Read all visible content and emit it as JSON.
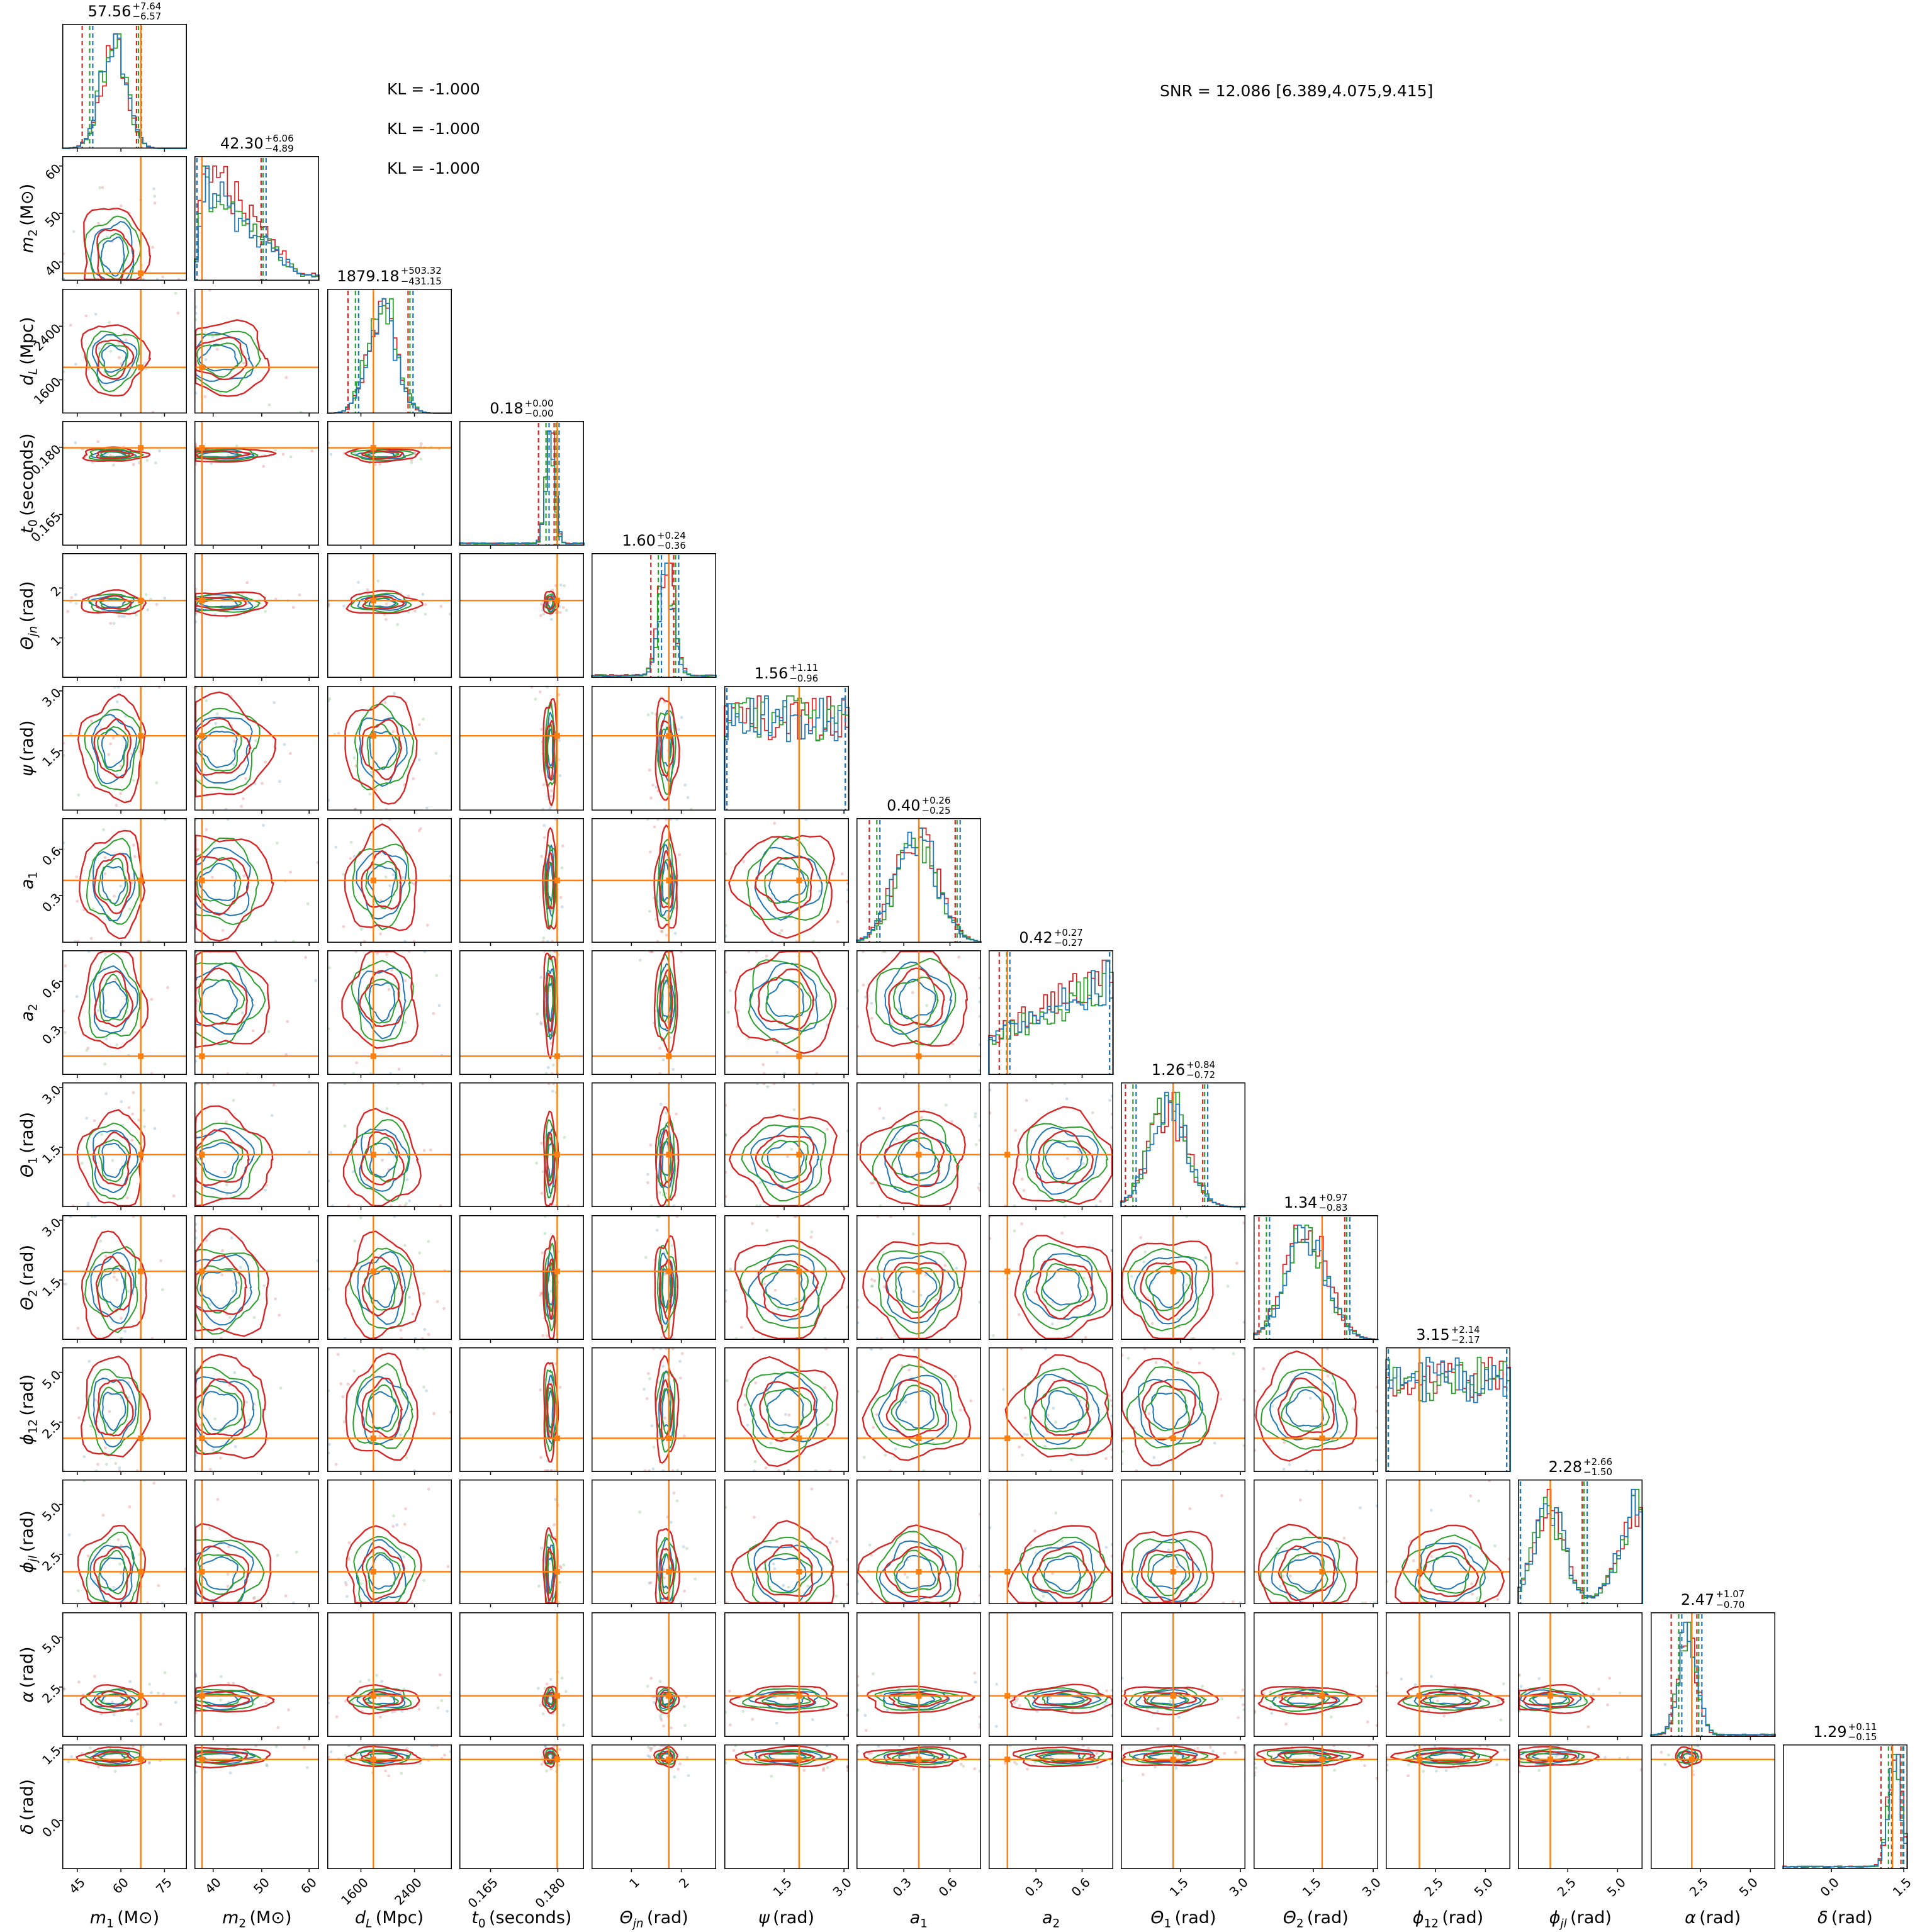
{
  "figure": {
    "annotations": {
      "kl_lines": [
        {
          "text": "KL = -1.000"
        },
        {
          "text": "KL = -1.000"
        },
        {
          "text": "KL = -1.000"
        }
      ],
      "snr": {
        "text": "SNR = 12.086 [6.389,4.075,9.415]"
      }
    }
  },
  "chart_data": {
    "type": "scatter",
    "subtype": "corner-plot-posterior",
    "n_parameters": 14,
    "series": [
      {
        "name": "posterior-run-1",
        "color": "#d62728"
      },
      {
        "name": "posterior-run-2",
        "color": "#2ca02c"
      },
      {
        "name": "posterior-run-3",
        "color": "#1f77b4"
      }
    ],
    "truth_color": "#ff7f0e",
    "annotations": [
      "KL = -1.000",
      "KL = -1.000",
      "KL = -1.000",
      "SNR = 12.086 [6.389,4.075,9.415]"
    ],
    "parameters": [
      {
        "name": "m1",
        "var": "m",
        "sub": "1",
        "unit": "(M⊙)",
        "median": "57.56",
        "plus": "+7.64",
        "minus": "−6.57",
        "ticks": [
          "45",
          "60",
          "75"
        ],
        "tick_fracs": [
          0.12,
          0.47,
          0.82
        ],
        "truth": 67.0,
        "truth_frac": 0.63,
        "shape": "bell",
        "peak": 0.41,
        "width": 0.17
      },
      {
        "name": "m2",
        "var": "m",
        "sub": "2",
        "unit": "(M⊙)",
        "median": "42.30",
        "plus": "+6.06",
        "minus": "−4.89",
        "ticks": [
          "40",
          "50",
          "60"
        ],
        "tick_fracs": [
          0.15,
          0.54,
          0.92
        ],
        "truth": 37.5,
        "truth_frac": 0.06,
        "shape": "fall",
        "peak": 0.2,
        "width": 0.3
      },
      {
        "name": "dL",
        "var": "d",
        "sub": "L",
        "unit": "(Mpc)",
        "median": "1879.18",
        "plus": "+503.32",
        "minus": "−431.15",
        "ticks": [
          "1600",
          "2400"
        ],
        "tick_fracs": [
          0.27,
          0.7
        ],
        "truth": 1790,
        "truth_frac": 0.37,
        "shape": "bell",
        "peak": 0.44,
        "width": 0.19
      },
      {
        "name": "t0",
        "var": "t",
        "sub": "0",
        "unit": "(seconds)",
        "median": "0.18",
        "plus": "+0.00",
        "minus": "−0.00",
        "ticks": [
          "0.165",
          "0.180"
        ],
        "tick_fracs": [
          0.25,
          0.79
        ],
        "truth": 0.18,
        "truth_frac": 0.785,
        "shape": "spike",
        "peak": 0.73,
        "width": 0.035
      },
      {
        "name": "theta_jn",
        "var": "Θ",
        "sub": "jn",
        "unit": "(rad)",
        "median": "1.60",
        "plus": "+0.24",
        "minus": "−0.36",
        "ticks": [
          "1",
          "2"
        ],
        "tick_fracs": [
          0.32,
          0.72
        ],
        "truth": 1.75,
        "truth_frac": 0.62,
        "shape": "spike",
        "peak": 0.6,
        "width": 0.06
      },
      {
        "name": "psi",
        "var": "ψ",
        "sub": "",
        "unit": "(rad)",
        "median": "1.56",
        "plus": "+1.11",
        "minus": "−0.96",
        "ticks": [
          "1.5",
          "3.0"
        ],
        "tick_fracs": [
          0.48,
          0.96
        ],
        "truth": 1.9,
        "truth_frac": 0.6,
        "shape": "flat",
        "peak": 0.5,
        "width": 0.45
      },
      {
        "name": "a1",
        "var": "a",
        "sub": "1",
        "unit": "",
        "median": "0.40",
        "plus": "+0.26",
        "minus": "−0.25",
        "ticks": [
          "0.3",
          "0.6"
        ],
        "tick_fracs": [
          0.38,
          0.75
        ],
        "truth": 0.4,
        "truth_frac": 0.5,
        "shape": "bell",
        "peak": 0.48,
        "width": 0.28
      },
      {
        "name": "a2",
        "var": "a",
        "sub": "2",
        "unit": "",
        "median": "0.42",
        "plus": "+0.27",
        "minus": "−0.27",
        "ticks": [
          "0.3",
          "0.6"
        ],
        "tick_fracs": [
          0.38,
          0.75
        ],
        "truth": 0.12,
        "truth_frac": 0.15,
        "shape": "rise",
        "peak": 0.6,
        "width": 0.4
      },
      {
        "name": "theta_1",
        "var": "Θ",
        "sub": "1",
        "unit": "(rad)",
        "median": "1.26",
        "plus": "+0.84",
        "minus": "−0.72",
        "ticks": [
          "1.5",
          "3.0"
        ],
        "tick_fracs": [
          0.48,
          0.96
        ],
        "truth": 1.3,
        "truth_frac": 0.42,
        "shape": "bell",
        "peak": 0.38,
        "width": 0.25
      },
      {
        "name": "theta_2",
        "var": "Θ",
        "sub": "2",
        "unit": "(rad)",
        "median": "1.34",
        "plus": "+0.97",
        "minus": "−0.83",
        "ticks": [
          "1.5",
          "3.0"
        ],
        "tick_fracs": [
          0.48,
          0.96
        ],
        "truth": 1.7,
        "truth_frac": 0.55,
        "shape": "bell",
        "peak": 0.42,
        "width": 0.28
      },
      {
        "name": "phi_12",
        "var": "ϕ",
        "sub": "12",
        "unit": "(rad)",
        "median": "3.15",
        "plus": "+2.14",
        "minus": "−2.17",
        "ticks": [
          "2.5",
          "5.0"
        ],
        "tick_fracs": [
          0.4,
          0.8
        ],
        "truth": 1.7,
        "truth_frac": 0.27,
        "shape": "flat",
        "peak": 0.5,
        "width": 0.45
      },
      {
        "name": "phi_jl",
        "var": "ϕ",
        "sub": "jl",
        "unit": "(rad)",
        "median": "2.28",
        "plus": "+2.66",
        "minus": "−1.50",
        "ticks": [
          "2.5",
          "5.0"
        ],
        "tick_fracs": [
          0.4,
          0.8
        ],
        "truth": 1.6,
        "truth_frac": 0.26,
        "shape": "u",
        "peak": 0.25,
        "width": 0.24
      },
      {
        "name": "alpha",
        "var": "α",
        "sub": "",
        "unit": "(rad)",
        "median": "2.47",
        "plus": "+1.07",
        "minus": "−0.70",
        "ticks": [
          "2.5",
          "5.0"
        ],
        "tick_fracs": [
          0.4,
          0.8
        ],
        "truth": 2.1,
        "truth_frac": 0.33,
        "shape": "spike",
        "peak": 0.3,
        "width": 0.07
      },
      {
        "name": "delta",
        "var": "δ",
        "sub": "",
        "unit": "(rad)",
        "median": "1.29",
        "plus": "+0.11",
        "minus": "−0.15",
        "ticks": [
          "0.0",
          "1.5"
        ],
        "tick_fracs": [
          0.39,
          0.97
        ],
        "truth": 1.26,
        "truth_frac": 0.88,
        "shape": "spike",
        "peak": 0.9,
        "width": 0.05
      }
    ]
  }
}
